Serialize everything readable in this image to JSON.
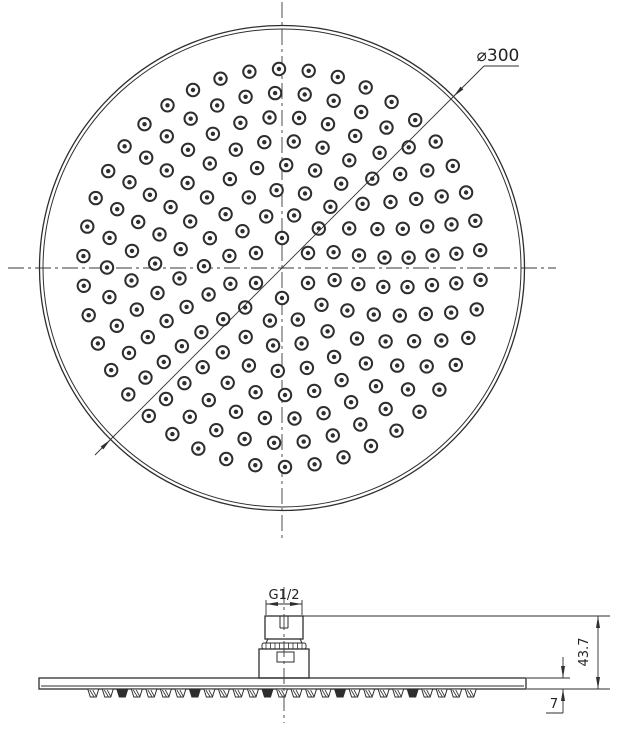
{
  "dimensions": {
    "diameter": "⌀300",
    "thread": "G1/2",
    "height": "43.7",
    "thickness": "7"
  },
  "colors": {
    "line": "#2e2e2e",
    "background": "#ffffff"
  },
  "top_view": {
    "center": {
      "x": 282,
      "y": 268
    },
    "rim_outer_radius": 242.5,
    "rim_inner_radius": 239,
    "nozzle": {
      "outer_radius": 6.2,
      "dot_radius": 2.2
    },
    "rings": [
      {
        "radius": 30,
        "count": 6,
        "start_deg": 90
      },
      {
        "radius": 54,
        "count": 12,
        "start_deg": 107
      },
      {
        "radius": 78,
        "count": 17,
        "start_deg": 94
      },
      {
        "radius": 103,
        "count": 22,
        "start_deg": 104
      },
      {
        "radius": 127,
        "count": 27,
        "start_deg": 98
      },
      {
        "radius": 151,
        "count": 32,
        "start_deg": 106
      },
      {
        "radius": 175,
        "count": 37,
        "start_deg": 102
      },
      {
        "radius": 199,
        "count": 42,
        "start_deg": 108
      }
    ]
  },
  "side_view": {
    "serrations": {
      "count": 27,
      "x_start": 86,
      "x_end": 478,
      "top_y": 689,
      "bottom_y": 697,
      "top_half_width": 5.5,
      "bottom_half_width": 3
    }
  }
}
